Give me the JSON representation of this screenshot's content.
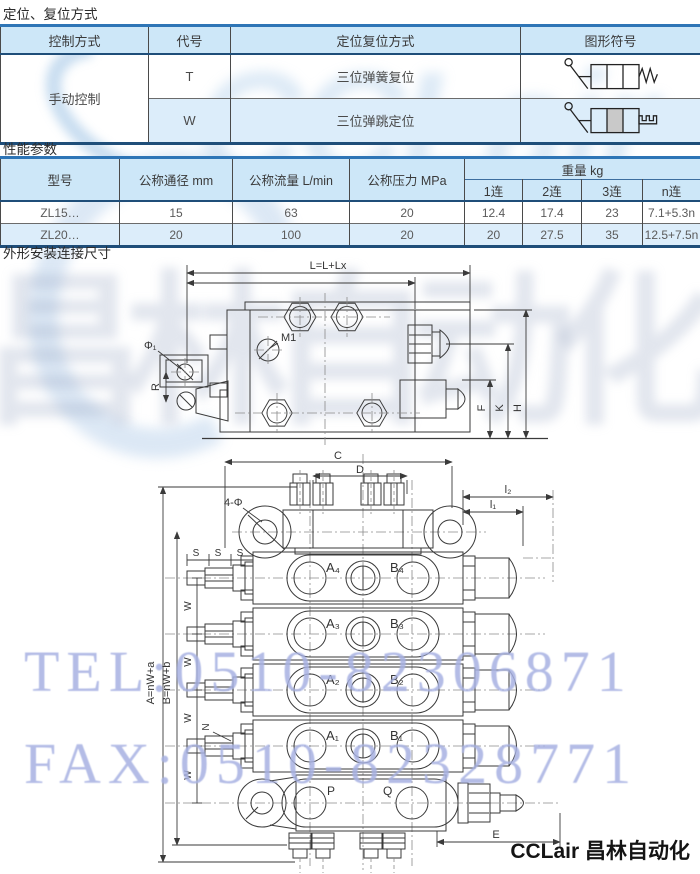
{
  "titles": {
    "positioning": "定位、复位方式",
    "performance": "性能参数",
    "dimensions": "外形安装连接尺寸"
  },
  "positioning_table": {
    "col_control": "控制方式",
    "col_code": "代号",
    "col_method": "定位复位方式",
    "col_symbol": "图形符号",
    "control_value": "手动控制",
    "rows": [
      {
        "code": "T",
        "method": "三位弹簧复位",
        "symbol_icon": "lever-spring-return-valve-symbol"
      },
      {
        "code": "W",
        "method": "三位弹跳定位",
        "symbol_icon": "lever-detent-valve-symbol"
      }
    ]
  },
  "performance_table": {
    "col_model": "型号",
    "col_diameter": "公称通径 mm",
    "col_flow": "公称流量 L/min",
    "col_pressure": "公称压力 MPa",
    "col_weight": "重量 kg",
    "weight_subcols": [
      "1连",
      "2连",
      "3连",
      "n连"
    ],
    "rows": [
      {
        "model": "ZL15…",
        "diameter": "15",
        "flow": "63",
        "pressure": "20",
        "w1": "12.4",
        "w2": "17.4",
        "w3": "23",
        "wn": "7.1+5.3n"
      },
      {
        "model": "ZL20…",
        "diameter": "20",
        "flow": "100",
        "pressure": "20",
        "w1": "20",
        "w2": "27.5",
        "w3": "35",
        "wn": "12.5+7.5n"
      }
    ]
  },
  "drawing_side_view": {
    "labels": {
      "overall_length": "L=L+Lx",
      "m1": "M1",
      "phi1": "Φ₁",
      "r": "R",
      "f": "F",
      "k": "K",
      "h": "H"
    }
  },
  "drawing_top_view": {
    "labels": {
      "c": "C",
      "d": "D",
      "holes": "4-Φ",
      "l1": "l₁",
      "l2": "l₂",
      "s": "S",
      "w": "W",
      "n": "N",
      "a": "A=nW+a",
      "b": "B=nW+b",
      "e": "E",
      "p": "P",
      "q": "Q",
      "a4": "A₄",
      "b4": "B₄",
      "a3": "A₃",
      "b3": "B₃",
      "a2": "A₂",
      "b2": "B₂",
      "a1": "A₁",
      "b1": "B₁"
    }
  },
  "watermarks": {
    "tel": "TEL:0510-82306871",
    "fax": "FAX:0510-82328771",
    "logo_latin": "CCLair",
    "logo_cn": "昌林自动化"
  },
  "footer": {
    "brand": "CCLair 昌林自动化"
  },
  "colors": {
    "header_bg": "#cde7f8",
    "row_alt_bg": "#dcedfa",
    "border_blue": "#2e75b6",
    "border_navy": "#1f4e79",
    "watermark_blue": "#a7b1e2"
  }
}
